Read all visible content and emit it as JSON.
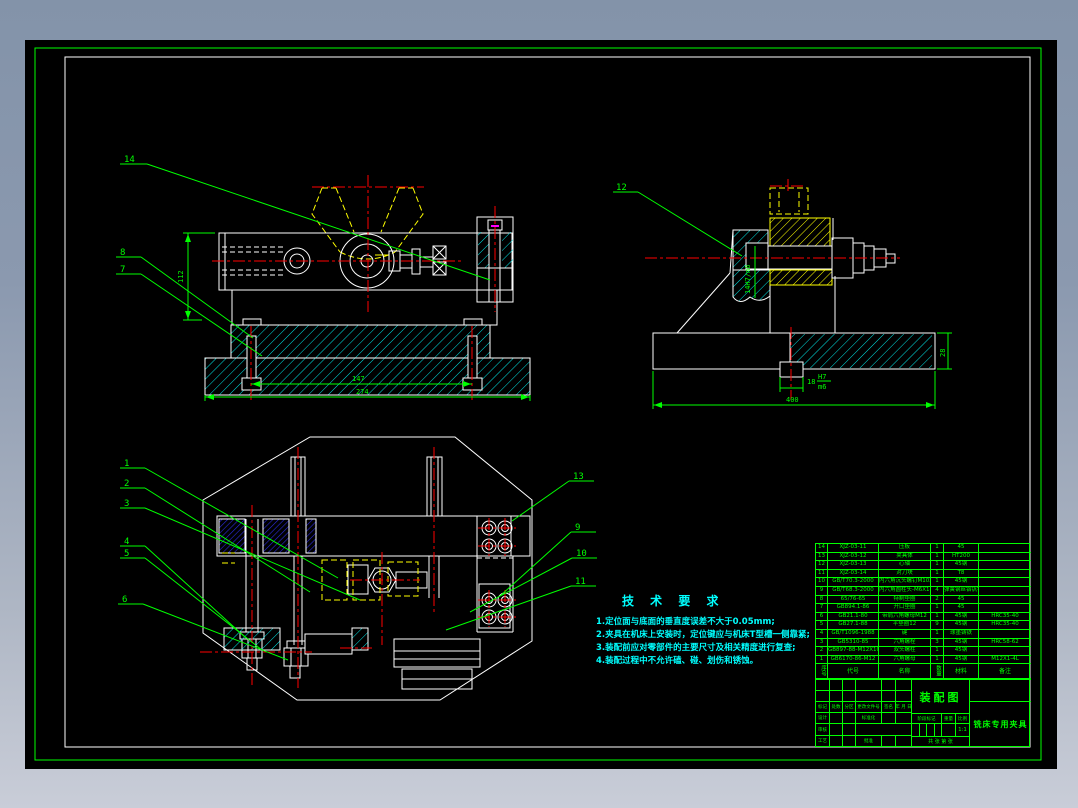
{
  "colors": {
    "background_top": "#8393a9",
    "background_bottom": "#c9cdd8",
    "canvas": "#000000",
    "line": "#ffffff",
    "annotation": "#00ff00",
    "centerline": "#ff0000",
    "hidden": "#ffff00",
    "section_cyan": "#00e5e5",
    "section_blue": "#2b2bdd",
    "tech_text": "#00ffff",
    "mark": "#ff00ff"
  },
  "tech_requirements": {
    "heading": "技 术 要 求",
    "lines": [
      "1.定位面与底面的垂直度误差不大于0.05mm;",
      "2.夹具在机床上安装时，定位键应与机床T型槽一侧靠紧;",
      "3.装配前应对零部件的主要尺寸及相关精度进行复查;",
      "4.装配过程中不允许磕、碰、划伤和锈蚀。"
    ]
  },
  "balloons": {
    "front": [
      "14",
      "8",
      "7"
    ],
    "side": [
      "12"
    ],
    "plan_left": [
      "1",
      "2",
      "3",
      "4",
      "5",
      "6"
    ],
    "plan_right": [
      "13",
      "9",
      "10",
      "11"
    ]
  },
  "dimensions": {
    "front": {
      "height": "112",
      "inner_width": "147",
      "total_width": "274"
    },
    "side": {
      "bore": "14H7/m6",
      "key_width": "18",
      "key_fit_top": "H7",
      "key_fit_bot": "m6",
      "base_height": "28",
      "base_width": "400"
    }
  },
  "bom": {
    "headers": [
      "序号",
      "代号",
      "名称",
      "数量",
      "材料",
      "备注"
    ],
    "rows": [
      {
        "no": "14",
        "code": "XJZ-03-11",
        "name": "压板",
        "qty": "1",
        "material": "45",
        "remark": ""
      },
      {
        "no": "13",
        "code": "XJZ-03-12",
        "name": "夹具体",
        "qty": "1",
        "material": "HT200",
        "remark": ""
      },
      {
        "no": "12",
        "code": "XJZ-03-13",
        "name": "心轴",
        "qty": "1",
        "material": "45钢",
        "remark": ""
      },
      {
        "no": "11",
        "code": "XJZ-03-14",
        "name": "对刀块",
        "qty": "1",
        "material": "T8",
        "remark": ""
      },
      {
        "no": "10",
        "code": "GB/T70.3-2000",
        "name": "内六角沉头螺钉M10X1",
        "qty": "1",
        "material": "45钢",
        "remark": ""
      },
      {
        "no": "9",
        "code": "GB/T68.3-2000",
        "name": "内六角圆柱头-M6X1-8",
        "qty": "4",
        "material": "弹簧钢丝铬钒钢",
        "remark": ""
      },
      {
        "no": "8",
        "code": "65/76-65",
        "name": "特制垫圈",
        "qty": "2",
        "material": "45",
        "remark": ""
      },
      {
        "no": "7",
        "code": "GB894.1-86",
        "name": "开口垫圈",
        "qty": "1",
        "material": "45",
        "remark": ""
      },
      {
        "no": "6",
        "code": "GB21.1-80",
        "name": "带肩六角螺母M12",
        "qty": "1",
        "material": "45钢",
        "remark": "HRC35-40"
      },
      {
        "no": "5",
        "code": "GB27.1-88",
        "name": "平垫圈12",
        "qty": "9",
        "material": "45钢",
        "remark": "HRC35-40"
      },
      {
        "no": "4",
        "code": "GB/T1096-1988",
        "name": "键",
        "qty": "1",
        "material": "球墨铸铁",
        "remark": ""
      },
      {
        "no": "3",
        "code": "GB5310-85",
        "name": "六角螺栓",
        "qty": "3",
        "material": "45钢",
        "remark": "HRC58-62"
      },
      {
        "no": "2",
        "code": "GB897-88-M12X105",
        "name": "双头螺柱",
        "qty": "1",
        "material": "45钢",
        "remark": ""
      },
      {
        "no": "1",
        "code": "GB6170-86-M12",
        "name": "六角螺母",
        "qty": "1",
        "material": "45钢",
        "remark": "M12X1-4L"
      }
    ]
  },
  "title_block": {
    "title": "装配图",
    "product": "铣床专用夹具",
    "sig_cols": [
      "标记",
      "处数",
      "分区",
      "更改文件号",
      "签名",
      "年 月 日"
    ],
    "role_design": "设计",
    "role_standard": "标准化",
    "role_audit": "审核",
    "role_process": "工艺",
    "role_approve": "批准",
    "stage_cols": [
      "阶段标记",
      "重量",
      "比例"
    ],
    "scale": "1:1",
    "sheet": "共 张 第 张"
  }
}
